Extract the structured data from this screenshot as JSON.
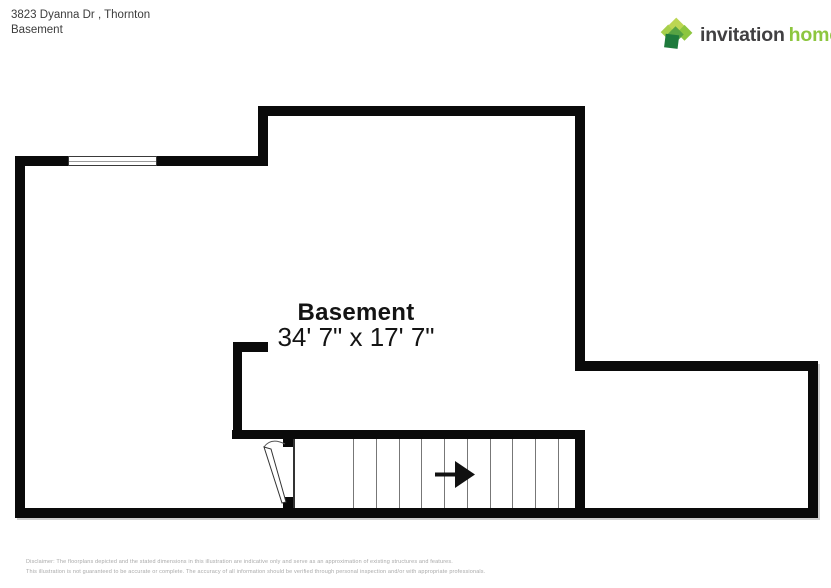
{
  "page": {
    "title_address": "3823 Dyanna Dr , Thornton",
    "title_floor": "Basement"
  },
  "logo": {
    "brand_first": "invitation",
    "brand_second": "homes",
    "trademark": "'",
    "brand_green": "#8dc63f",
    "brand_dark": "#414042"
  },
  "floorplan": {
    "room_label": "Basement",
    "room_dimensions": "34' 7\" x 17' 7\"",
    "wall_color": "#0a0a0a",
    "stair_direction_icon": "right-arrow",
    "window_icon": "window-symbol",
    "door_icon": "door-swing-symbol"
  },
  "disclaimer": {
    "line1": "Disclaimer: The floorplans depicted and the stated dimensions in this illustration are indicative only and serve as an approximation of existing structures and features.",
    "line2": "This illustration is not guaranteed to be accurate or complete. The accuracy of all information should be verified through personal inspection and/or with appropriate professionals."
  }
}
